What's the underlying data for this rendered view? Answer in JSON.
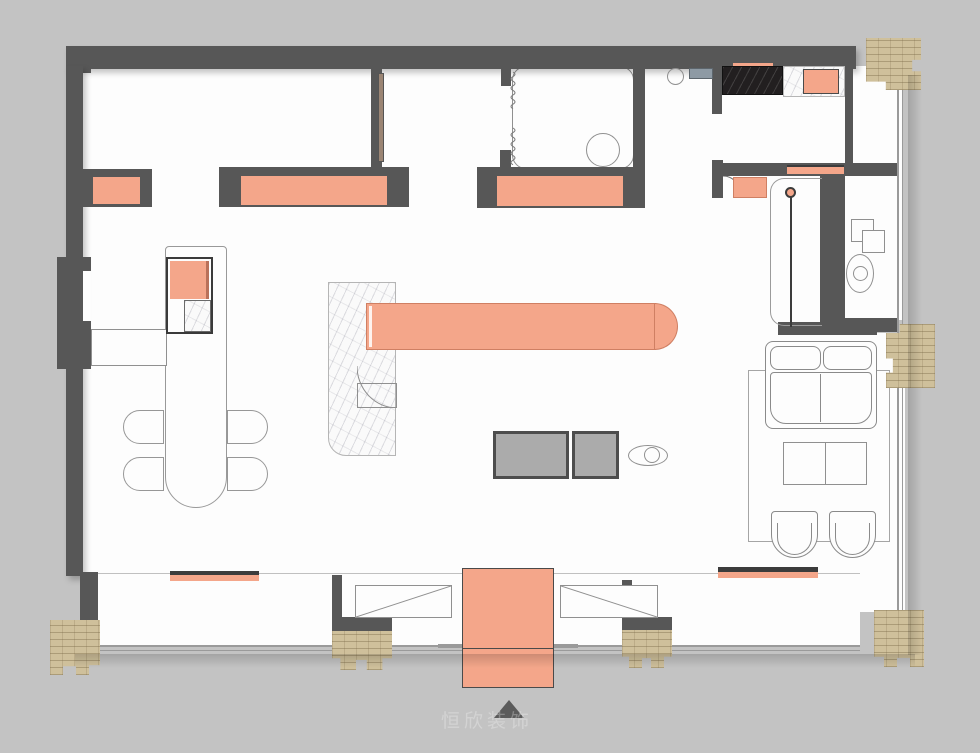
{
  "meta": {
    "type": "apartment floor plan drawing",
    "watermark": "恒欣装饰"
  },
  "palette": {
    "background": "#c3c3c3",
    "wall": "#575757",
    "floor": "#fdfdfd",
    "accent_salmon": "#f4a68a",
    "salmon_border": "#cf7f63",
    "column_tan": "#cfc09b",
    "counter_black": "#221f20",
    "table_gray": "#ababab",
    "outline_gray": "#909090",
    "glass": "#9a9a9a",
    "door_panel": "#9b8574",
    "sink_slate": "#8e9aa4"
  },
  "elements": [
    "exterior-wall",
    "interior-partition",
    "brick-column",
    "window-glazing",
    "window-bench",
    "closet",
    "wardrobe",
    "bathroom-floor",
    "toilet",
    "shower-spring-symbol",
    "kitchen-counter-black-marble",
    "kitchen-counter-white-marble",
    "cooktop",
    "sink",
    "sink-shelf",
    "entry-hall",
    "entry-door-arc",
    "sliding-door",
    "entry-rug",
    "utility-stacked-boxes",
    "washbasin",
    "sideboard",
    "dining-table",
    "dining-chair",
    "wall-desk",
    "kitchen-island-marble",
    "bar-counter",
    "gray-coffee-table",
    "decor-ellipse",
    "living-rug",
    "sofa",
    "lounge-chair",
    "living-coffee-table",
    "shoe-cabinet",
    "entry-mat",
    "north-arrow"
  ]
}
